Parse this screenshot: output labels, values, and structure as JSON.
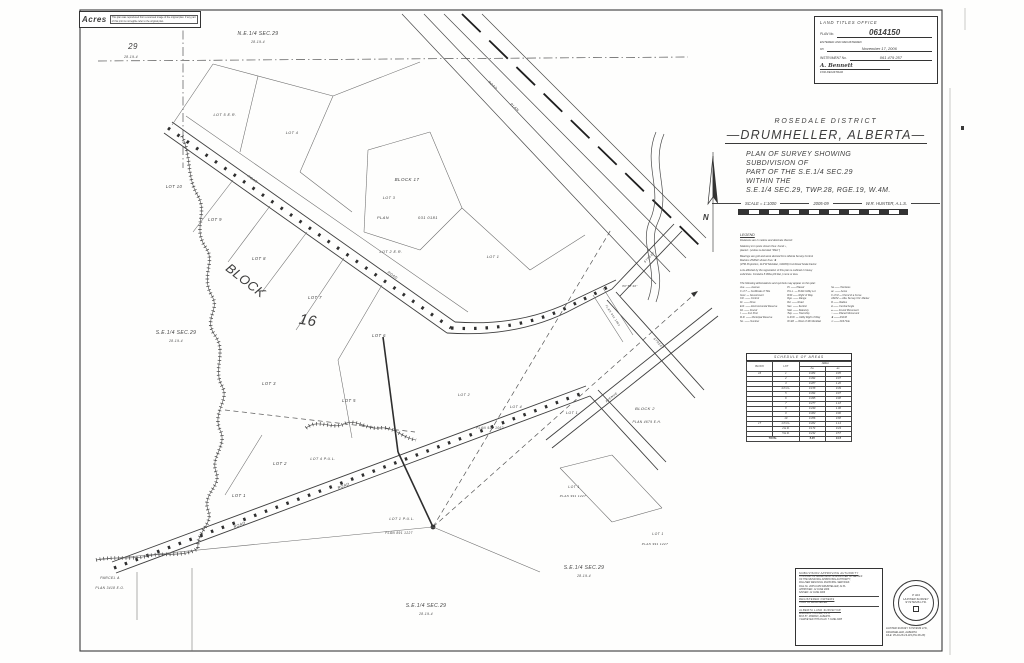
{
  "corner_stamp": {
    "logo": "Acres",
    "note_line1": "This plan was reproduced from a scanned image of the original plan.",
    "note_line2": "If any part of this print is not legible refer to the original plan."
  },
  "land_titles": {
    "office": "LAND TITLES OFFICE",
    "plan_label": "PLAN No.",
    "plan_number": "0614150",
    "entered": "ENTERED AND REGISTERED",
    "date_label": "on",
    "date": "November 17, 2006",
    "instrument_label": "INSTRUMENT No.",
    "instrument": "061 479 257",
    "signature": "A. Bennett",
    "for_registrar": "FOR REGISTRAR"
  },
  "title_block": {
    "district": "ROSEDALE DISTRICT",
    "city": "—DRUMHELLER, ALBERTA—",
    "desc_lines": [
      "PLAN OF SURVEY SHOWING",
      "SUBDIVISION OF",
      "PART OF THE S.E.1/4 SEC.29",
      "WITHIN THE",
      "S.E.1/4 SEC.29, TWP.28, RGE.19, W.4M."
    ],
    "scale": "SCALE = 1:1000",
    "year": "2005-09",
    "surveyor": "W.R. HUNTER, A.L.S."
  },
  "legend": {
    "heading": "LEGEND",
    "notes": [
      "Distances are in metres and decimals thereof.",
      "",
      "Statutory iron posts shown thus: found ▪ ,",
      "placed ▫ (unless is denoted \"Mkd.\")",
      "",
      "Bearings are grid and were derived from Alberta Survey Control",
      "Markers 254822 shown thus: ✸",
      "(3TM Projection, 114°W Meridian, NAD83) Combined Scale Factor.",
      "",
      "Lots affected by the registration of this plan is outlined in heavy",
      "solid lines. Contains 8.09ha (20.0ac.) more or less."
    ],
    "intro": "The following abbreviations and symbols may appear on this plan:",
    "col1": [
      "Ave. —— Avenue",
      "C of T — Certificate of Title",
      "Govt. — Government",
      "Ctrl. —— Control",
      "Dr. —— Drive",
      "E.R. —— Environmental Reserve",
      "Fd. —— Found",
      "I. —— Iron Post",
      "M.R. —— Municipal Reserve",
      "No. —— Number"
    ],
    "col2": [
      "Pl. —— Placed",
      "P.U.L. — Public Utility Lot",
      "R/W —— Right of Way",
      "Rge. —— Range",
      "Rd. —— Road",
      "Sec. —— Section",
      "Stat. —— Statutory",
      "Twp. —— Township",
      "U.R.W. — Utility Right of Way",
      "W.4M. — West of 4th Meridian"
    ],
    "col3": [
      "ha —— Hectares",
      "ac. —— Acres",
      "C of M — Chord of a Curve",
      "ASCM — Alta. Survey Ctrl. Marker",
      "R —— Radius",
      "Δ —— Central Angle",
      "● —— Found Monument",
      "○ —— Placed Monument",
      "✸ —— ASCM",
      "⊙ —— Drill Hole"
    ]
  },
  "schedule": {
    "title": "SCHEDULE  OF  AREAS",
    "col_block": "BLOCK",
    "col_lot": "LOT",
    "col_area": "AREA",
    "col_ha": "ha",
    "col_ac": "ac.",
    "rows": [
      [
        "16",
        "1",
        "0.384",
        "0.95"
      ],
      [
        "",
        "2",
        "0.394",
        "0.97"
      ],
      [
        "",
        "3",
        "0.487",
        "1.20"
      ],
      [
        "",
        "4 P.U.L.",
        "0.158",
        "0.39"
      ],
      [
        "",
        "5",
        "0.394",
        "0.97"
      ],
      [
        "",
        "6",
        "0.395",
        "0.98"
      ],
      [
        "",
        "7",
        "0.477",
        "1.18"
      ],
      [
        "",
        "8",
        "0.430",
        "1.06"
      ],
      [
        "",
        "9",
        "0.363",
        "0.90"
      ],
      [
        "",
        "10",
        "0.356",
        "0.88"
      ],
      [
        "17",
        "1 P.U.L.",
        "0.462",
        "1.14"
      ],
      [
        "",
        "2 E.R.",
        "0.174",
        "0.43"
      ],
      [
        "",
        "5 E.R.",
        "0.232",
        "0.57"
      ]
    ],
    "total_label": "TOTAL",
    "total_ha": "5.45",
    "total_ac": "13.5"
  },
  "approvals": {
    "authority_heading": "SUBDIVISION APPROVING AUTHORITY",
    "authority_lines": [
      "THIS PLAN OF SUBDIVISION IS APPROVED ON BEHALF",
      "OF THE MUNICIPAL APPROVING AUTHORITY,",
      "PALLISER REGIONAL MUNICIPAL SERVICES",
      "FILE No. 2005-0-089    DRUMHELLER, ALTA.",
      "APPROVED: 12 JUNE 2006",
      "SIGNED: 12 JUNE 2006"
    ],
    "owners_heading": "REGISTERED OWNERS",
    "owners_lines": [
      "TOWN OF DRUMHELLER"
    ],
    "surveyor_heading": "ALBERTA LAND SURVEYOR",
    "surveyor_lines": [
      "WILLIAM R. HUNTER, A.L.S.",
      "BOX 87, MORRIN, ALBERTA",
      "I SURVEYED THIS PLAN: 7 JUNE 2005"
    ]
  },
  "stamp": {
    "permit": "P 324",
    "line1": "HUNTER SURVEY",
    "line2": "SYSTEMS LTD."
  },
  "firm": {
    "line1": "HUNTER SURVEY SYSTEMS LTD.,",
    "line2": "DRUMHELLER, ALBERTA",
    "line3": "FILE: 05-29-28-19-W4 (PH:06-28)"
  },
  "map_labels": [
    {
      "t": "N.E.1/4 SEC.29",
      "x": 258,
      "y": 35,
      "s": 5
    },
    {
      "t": "28-19-4",
      "x": 258,
      "y": 43,
      "s": 3.2
    },
    {
      "t": "29",
      "x": 133,
      "y": 49,
      "s": 8
    },
    {
      "t": "28-19-4",
      "x": 131,
      "y": 58,
      "s": 3.2
    },
    {
      "t": "S.E.1/4 SEC.29",
      "x": 176,
      "y": 334,
      "s": 5
    },
    {
      "t": "28-19-4",
      "x": 176,
      "y": 342,
      "s": 3.2
    },
    {
      "t": "S.E.1/4 SEC.29",
      "x": 584,
      "y": 569,
      "s": 5
    },
    {
      "t": "28-19-4",
      "x": 584,
      "y": 577,
      "s": 3.2
    },
    {
      "t": "S.E.1/4 SEC.29",
      "x": 426,
      "y": 607,
      "s": 5
    },
    {
      "t": "28-19-4",
      "x": 426,
      "y": 615,
      "s": 3.2
    },
    {
      "t": "BLOCK",
      "x": 243,
      "y": 284,
      "s": 13,
      "r": 38
    },
    {
      "t": "16",
      "x": 307,
      "y": 325,
      "s": 15,
      "r": 10
    },
    {
      "t": "BLOCK  17",
      "x": 407,
      "y": 181,
      "s": 4.5
    },
    {
      "t": "PLAN",
      "x": 383,
      "y": 219,
      "s": 4
    },
    {
      "t": "031 0181",
      "x": 428,
      "y": 219,
      "s": 4
    },
    {
      "t": "LOT 10",
      "x": 174,
      "y": 188,
      "s": 4.2
    },
    {
      "t": "LOT 9",
      "x": 215,
      "y": 221,
      "s": 4.2
    },
    {
      "t": "LOT 8",
      "x": 259,
      "y": 260,
      "s": 4.2
    },
    {
      "t": "LOT 7",
      "x": 315,
      "y": 299,
      "s": 4.2
    },
    {
      "t": "LOT 6",
      "x": 379,
      "y": 337,
      "s": 4.2
    },
    {
      "t": "LOT 5 E.R.",
      "x": 225,
      "y": 116,
      "s": 3.8
    },
    {
      "t": "LOT 4",
      "x": 292,
      "y": 134,
      "s": 3.8
    },
    {
      "t": "LOT 3",
      "x": 389,
      "y": 199,
      "s": 3.8
    },
    {
      "t": "LOT 2 E.R.",
      "x": 391,
      "y": 253,
      "s": 3.8
    },
    {
      "t": "LOT 1",
      "x": 493,
      "y": 258,
      "s": 3.8
    },
    {
      "t": "LOT 3",
      "x": 269,
      "y": 385,
      "s": 4.2
    },
    {
      "t": "LOT 5",
      "x": 349,
      "y": 402,
      "s": 4.2
    },
    {
      "t": "LOT 2",
      "x": 280,
      "y": 465,
      "s": 4.2
    },
    {
      "t": "LOT 4 P.U.L.",
      "x": 323,
      "y": 460,
      "s": 3.6
    },
    {
      "t": "LOT 1",
      "x": 239,
      "y": 497,
      "s": 4.2
    },
    {
      "t": "LOT 1 P.U.L.",
      "x": 402,
      "y": 520,
      "s": 3.6
    },
    {
      "t": "PLAN  891 1227",
      "x": 399,
      "y": 534,
      "s": 3.2
    },
    {
      "t": "LOT 2",
      "x": 464,
      "y": 396,
      "s": 3.6
    },
    {
      "t": "LOT 4",
      "x": 516,
      "y": 408,
      "s": 3.6
    },
    {
      "t": "LOT 1",
      "x": 572,
      "y": 414,
      "s": 3.6
    },
    {
      "t": "PLAN  931 1062",
      "x": 490,
      "y": 429,
      "s": 3.2
    },
    {
      "t": "LOT 1",
      "x": 574,
      "y": 488,
      "s": 3.4
    },
    {
      "t": "PLAN 991 1227",
      "x": 573,
      "y": 497,
      "s": 3
    },
    {
      "t": "LOT 1",
      "x": 658,
      "y": 535,
      "s": 3.4
    },
    {
      "t": "PLAN 991 1227",
      "x": 655,
      "y": 545,
      "s": 3
    },
    {
      "t": "BLOCK  2",
      "x": 645,
      "y": 410,
      "s": 4
    },
    {
      "t": "PLAN 4679 E.H.",
      "x": 647,
      "y": 423,
      "s": 3.2
    },
    {
      "t": "ROAD",
      "x": 252,
      "y": 180,
      "s": 3.4,
      "r": 35
    },
    {
      "t": "ROAD",
      "x": 392,
      "y": 276,
      "s": 3.4,
      "r": 35
    },
    {
      "t": "ROAD",
      "x": 344,
      "y": 487,
      "s": 3.8,
      "r": -21
    },
    {
      "t": "ROAD",
      "x": 240,
      "y": 526,
      "s": 3.8,
      "r": -21
    },
    {
      "t": "ROAD",
      "x": 492,
      "y": 86,
      "s": 3.4,
      "r": 43
    },
    {
      "t": "PLAN",
      "x": 514,
      "y": 108,
      "s": 3.4,
      "r": 43
    },
    {
      "t": "STREET",
      "x": 650,
      "y": 258,
      "s": 3,
      "r": -46
    },
    {
      "t": "STREET",
      "x": 658,
      "y": 344,
      "s": 3,
      "r": 48
    },
    {
      "t": "AVENUE",
      "x": 612,
      "y": 398,
      "s": 3,
      "r": -38
    },
    {
      "t": "PLAN 931 1062",
      "x": 612,
      "y": 316,
      "s": 2.8,
      "r": 57
    },
    {
      "t": "PARCEL  A",
      "x": 110,
      "y": 579,
      "s": 3.4
    },
    {
      "t": "PLAN 3418 E.O.",
      "x": 110,
      "y": 589,
      "s": 3.2
    },
    {
      "t": "89°58'40\"",
      "x": 630,
      "y": 287,
      "s": 2.8
    },
    {
      "t": "N",
      "x": 706,
      "y": 220,
      "s": 8,
      "w": "bold"
    }
  ]
}
